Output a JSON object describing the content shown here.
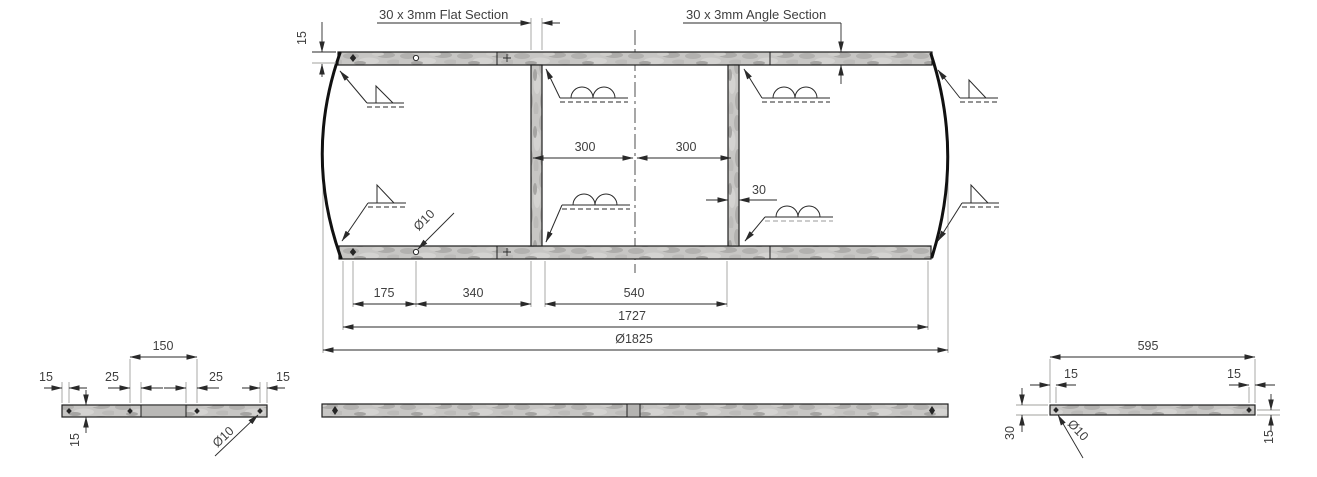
{
  "drawing_title": "circular frame fabrication drawing",
  "colors": {
    "background": "#ffffff",
    "line": "#1f1f1f",
    "extension_line": "#a0a09e",
    "dimension_text": "#3f3f3f",
    "metal_base": "#c7c6c4"
  },
  "callouts": {
    "flat_section": "30 x 3mm Flat Section",
    "angle_section": "30 x 3mm Angle Section"
  },
  "main_view": {
    "dims": {
      "edge_offset": "15",
      "bay_left": "300",
      "bay_right": "300",
      "bar_width": "30",
      "hole_dia": "Ø10",
      "hole_pitch": "175",
      "hole_to_bar": "340",
      "bar_spacing": "540",
      "frame_length": "1727",
      "overall_diameter": "Ø1825"
    }
  },
  "end_bar_view": {
    "dims": {
      "hole_span": "150",
      "end_left": "15",
      "edge_left": "25",
      "edge_right": "25",
      "end_right": "15",
      "hole_offset": "15",
      "hole_dia": "Ø10"
    }
  },
  "side_bar_view": {
    "dims": {
      "length": "595",
      "end_left": "15",
      "end_right": "15",
      "width": "30",
      "hole_offset": "15",
      "hole_dia": "Ø10"
    }
  }
}
